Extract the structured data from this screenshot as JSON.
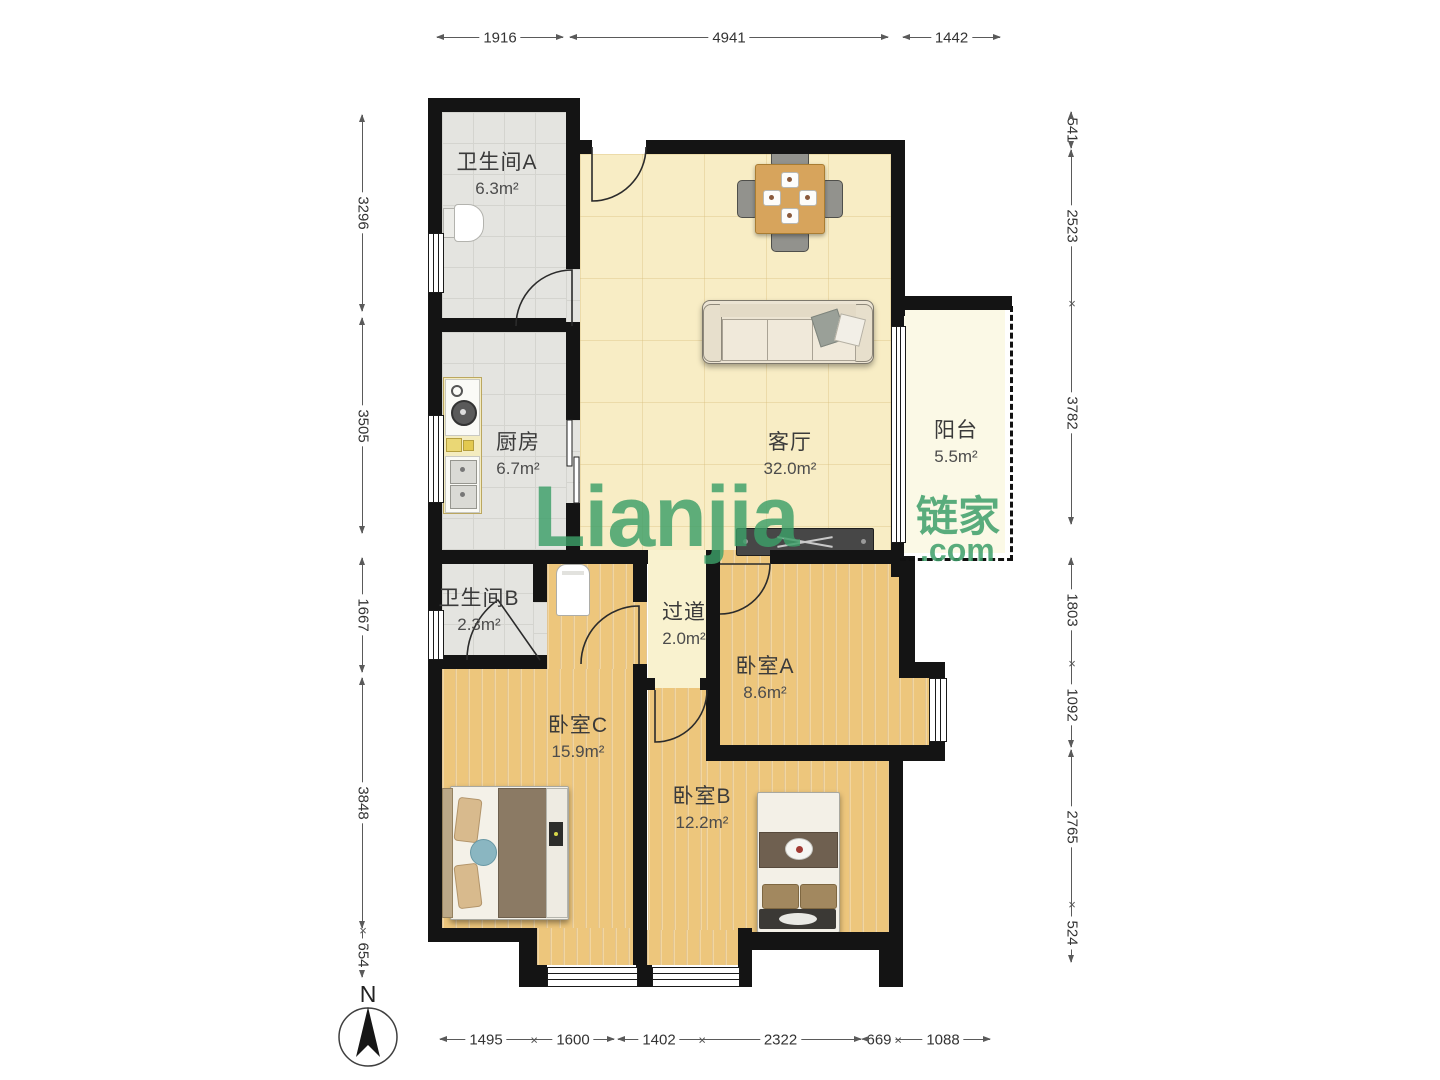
{
  "watermark": {
    "latin": "Lianjia",
    "cn": "链家",
    "com": ".com",
    "color": "#3aa06a"
  },
  "compass": {
    "label": "N"
  },
  "rooms": [
    {
      "name": "卫生间A",
      "area": "6.3m²",
      "x": 497,
      "y": 146
    },
    {
      "name": "厨房",
      "area": "6.7m²",
      "x": 518,
      "y": 426
    },
    {
      "name": "客厅",
      "area": "32.0m²",
      "x": 790,
      "y": 426
    },
    {
      "name": "阳台",
      "area": "5.5m²",
      "x": 956,
      "y": 414
    },
    {
      "name": "卫生间B",
      "area": "2.3m²",
      "x": 479,
      "y": 582
    },
    {
      "name": "过道",
      "area": "2.0m²",
      "x": 684,
      "y": 596
    },
    {
      "name": "卧室A",
      "area": "8.6m²",
      "x": 765,
      "y": 650
    },
    {
      "name": "卧室C",
      "area": "15.9m²",
      "x": 578,
      "y": 709
    },
    {
      "name": "卧室B",
      "area": "12.2m²",
      "x": 702,
      "y": 780
    }
  ],
  "dimensions": {
    "top": [
      {
        "label": "1916",
        "x": 437,
        "y": 38,
        "len": 126,
        "s": "arrow",
        "e": "arrow"
      },
      {
        "label": "4941",
        "x": 570,
        "y": 38,
        "len": 318,
        "s": "arrow",
        "e": "arrow"
      },
      {
        "label": "1442",
        "x": 903,
        "y": 38,
        "len": 97,
        "s": "arrow",
        "e": "arrow"
      }
    ],
    "bottom": [
      {
        "label": "1495",
        "x": 440,
        "y": 1040,
        "len": 92,
        "s": "arrow",
        "e": "x"
      },
      {
        "label": "1600",
        "x": 532,
        "y": 1040,
        "len": 82,
        "s": "none",
        "e": "arrow"
      },
      {
        "label": "1402",
        "x": 618,
        "y": 1040,
        "len": 82,
        "s": "arrow",
        "e": "x"
      },
      {
        "label": "2322",
        "x": 700,
        "y": 1040,
        "len": 161,
        "s": "none",
        "e": "arrow"
      },
      {
        "label": "669",
        "x": 862,
        "y": 1040,
        "len": 34,
        "s": "arrow",
        "e": "x"
      },
      {
        "label": "1088",
        "x": 896,
        "y": 1040,
        "len": 94,
        "s": "none",
        "e": "arrow"
      }
    ],
    "left": [
      {
        "label": "3296",
        "x": 363,
        "y": 115,
        "len": 196,
        "s": "arrow",
        "e": "arrow"
      },
      {
        "label": "3505",
        "x": 363,
        "y": 318,
        "len": 215,
        "s": "arrow",
        "e": "arrow"
      },
      {
        "label": "1667",
        "x": 363,
        "y": 558,
        "len": 114,
        "s": "arrow",
        "e": "arrow"
      },
      {
        "label": "3848",
        "x": 363,
        "y": 678,
        "len": 250,
        "s": "arrow",
        "e": "arrow"
      },
      {
        "label": "654",
        "x": 363,
        "y": 932,
        "len": 45,
        "s": "x",
        "e": "arrow"
      }
    ],
    "right": [
      {
        "label": "541",
        "x": 1072,
        "y": 112,
        "len": 36,
        "s": "arrow",
        "e": "arrow"
      },
      {
        "label": "2523",
        "x": 1072,
        "y": 150,
        "len": 152,
        "s": "arrow",
        "e": "x"
      },
      {
        "label": "3782",
        "x": 1072,
        "y": 302,
        "len": 222,
        "s": "none",
        "e": "arrow"
      },
      {
        "label": "1803",
        "x": 1072,
        "y": 558,
        "len": 104,
        "s": "arrow",
        "e": "x"
      },
      {
        "label": "1092",
        "x": 1072,
        "y": 662,
        "len": 85,
        "s": "none",
        "e": "arrow"
      },
      {
        "label": "2765",
        "x": 1072,
        "y": 750,
        "len": 153,
        "s": "arrow",
        "e": "x"
      },
      {
        "label": "524",
        "x": 1072,
        "y": 903,
        "len": 59,
        "s": "none",
        "e": "arrow"
      }
    ]
  }
}
